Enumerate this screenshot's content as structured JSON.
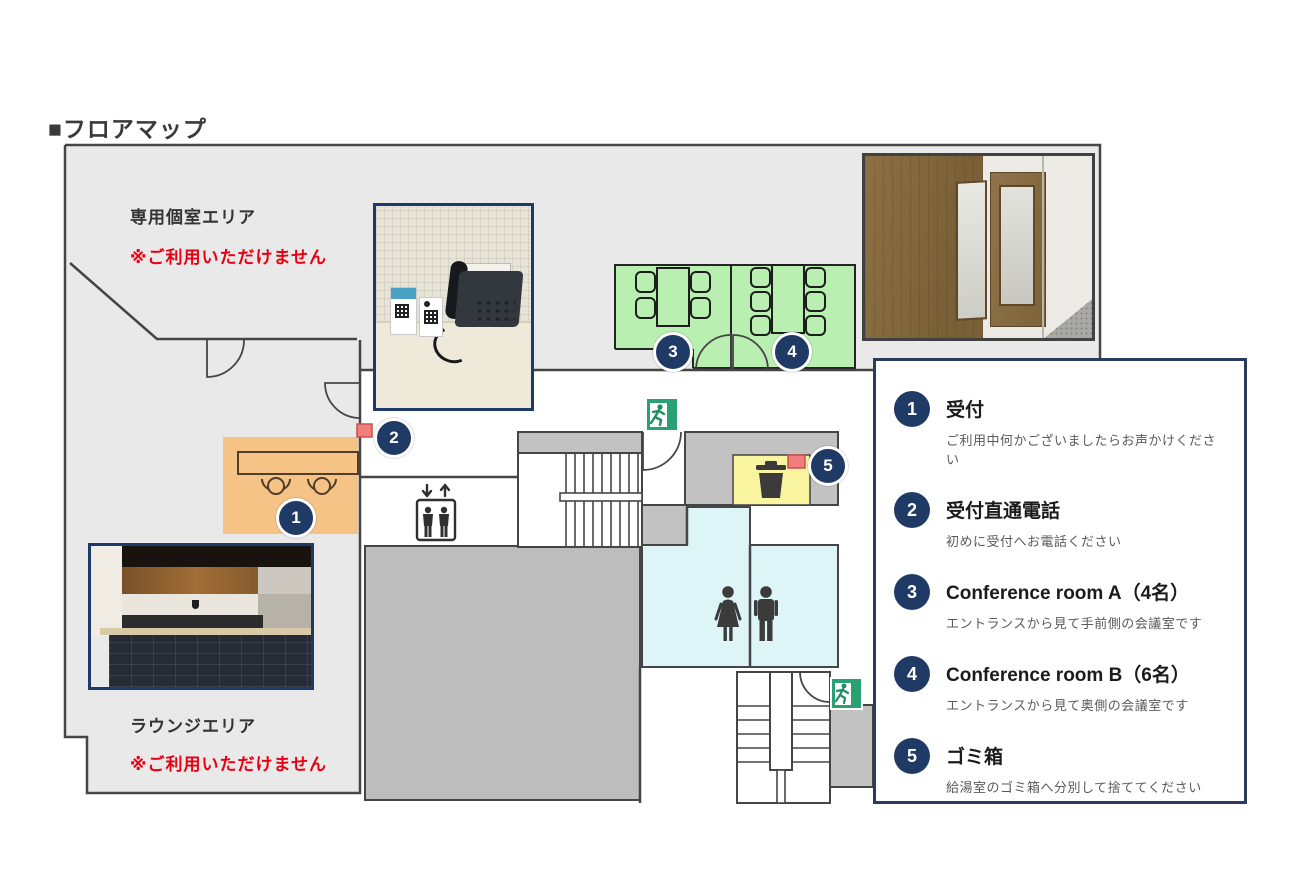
{
  "page": {
    "title": "■フロアマップ"
  },
  "map": {
    "private_area": {
      "label": "専用個室エリア",
      "notice": "※ご利用いただけません"
    },
    "lounge_area": {
      "label": "ラウンジエリア",
      "notice": "※ご利用いただけません"
    },
    "badges": {
      "reception": "1",
      "phone": "2",
      "room_a": "3",
      "room_b": "4",
      "trash": "5"
    },
    "icons": [
      "exit-running-man-icon",
      "elevator-icon",
      "trash-can-icon",
      "female-icon",
      "male-icon",
      "door-swing-arc",
      "stairs",
      "reception-desk",
      "conference-table-chairs",
      "phone-location-marker"
    ]
  },
  "legend": {
    "items": [
      {
        "number": "1",
        "title": "受付",
        "description": "ご利用中何かございましたらお声かけください"
      },
      {
        "number": "2",
        "title": "受付直通電話",
        "description": "初めに受付へお電話ください"
      },
      {
        "number": "3",
        "title": "Conference room A（4名）",
        "description": "エントランスから見て手前側の会議室です"
      },
      {
        "number": "4",
        "title": "Conference room B（6名）",
        "description": "エントランスから見て奥側の会議室です"
      },
      {
        "number": "5",
        "title": "ゴミ箱",
        "description": "給湯室のゴミ箱へ分別して捨ててください"
      }
    ]
  },
  "colors": {
    "accent_navy": "#203a66",
    "legend_border_navy": "#2b3b5c",
    "notice_red": "#e60012",
    "floor_gray": "#e9e9e9",
    "corridor_gray": "#c2c2c2",
    "wall_gray": "#454545",
    "room_green": "#b9f0b2",
    "reception_orange": "#f6c387",
    "trash_yellow": "#f8f4a0",
    "restroom_cyan": "#def5f8",
    "exit_green": "#2aa173",
    "phone_marker_red": "#f27d7d"
  }
}
